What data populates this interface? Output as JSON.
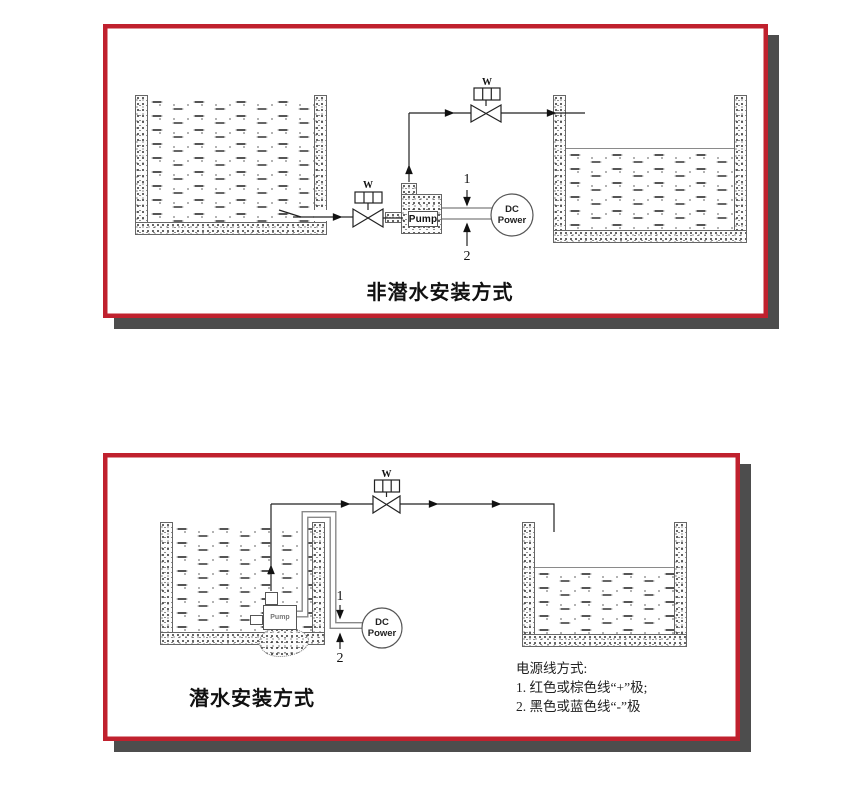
{
  "top": {
    "title": "非潜水安装方式",
    "inlet_valve_label": "W",
    "outlet_valve_label": "W",
    "pump_label": "Pump",
    "dc_power_line1": "DC",
    "dc_power_line2": "Power",
    "wire_positive_label": "1",
    "wire_negative_label": "2"
  },
  "bottom": {
    "title": "潜水安装方式",
    "valve_label": "W",
    "pump_label": "Pump",
    "dc_power_line1": "DC",
    "dc_power_line2": "Power",
    "wire_positive_label": "1",
    "wire_negative_label": "2",
    "notes_heading": "电源线方式:",
    "notes_line1": "1. 红色或棕色线“+”极;",
    "notes_line2": "2. 黑色或蓝色线“-”极"
  },
  "colors": {
    "frame_red": "#c0212e",
    "shadow_gray": "#4d4d4d"
  }
}
